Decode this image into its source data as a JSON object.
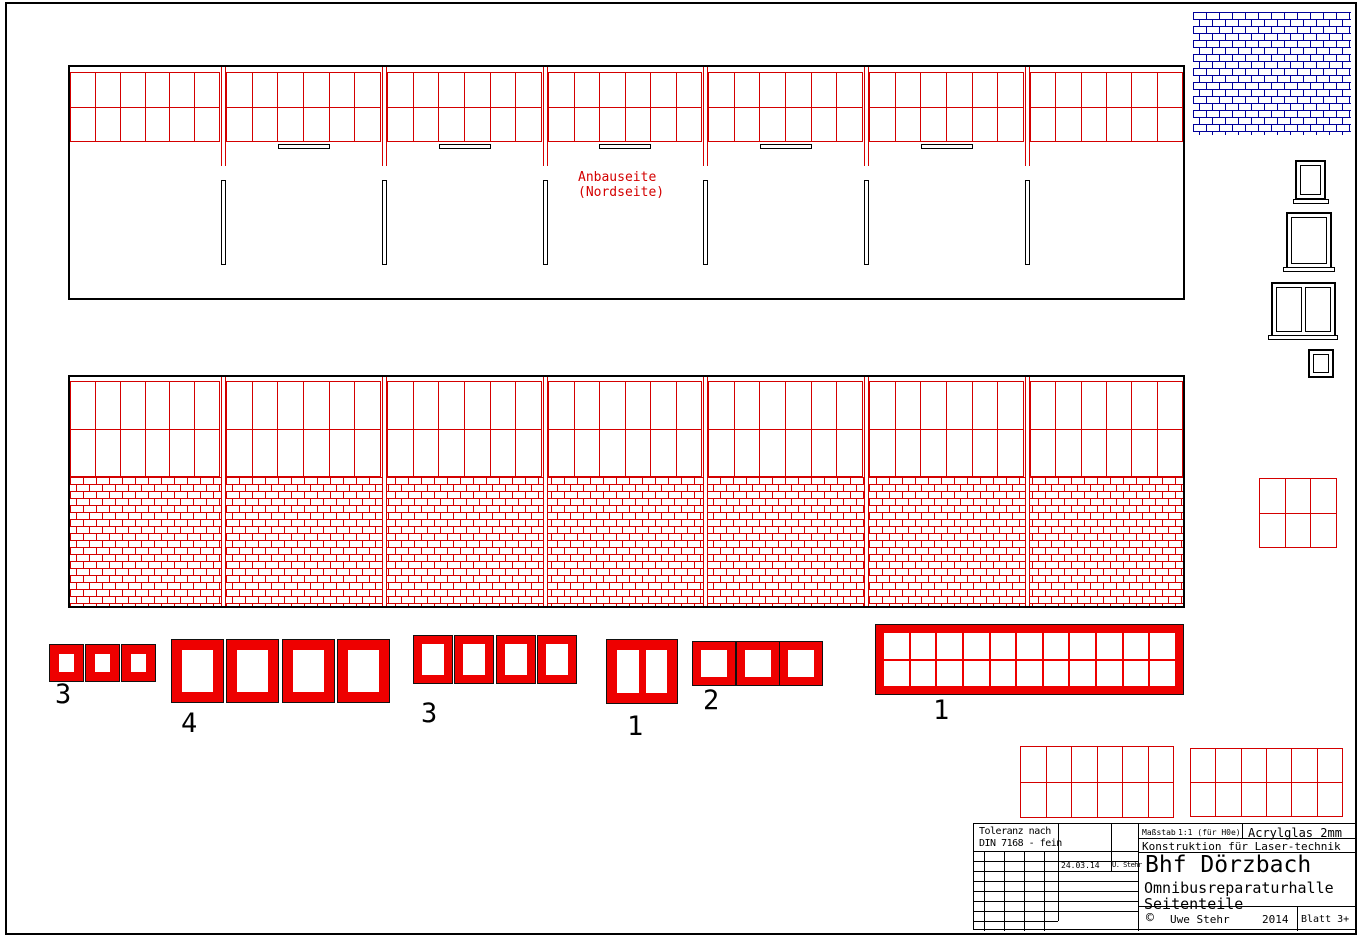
{
  "colors": {
    "red_line": "#d40000",
    "red_fill": "#ee0000",
    "blue": "#000099",
    "black": "#000000"
  },
  "annotations": {
    "north_label_line1": "Anbauseite",
    "north_label_line2": "(Nordseite)"
  },
  "structure": {
    "north_elevation": {
      "panels": 7,
      "window_cols": 6,
      "window_rows": 2,
      "dividers": 6,
      "pillars": 6,
      "sills": 5
    },
    "south_elevation": {
      "panels": 7,
      "window_cols": 6,
      "window_rows": 2,
      "brick_base": true,
      "dividers": 6
    },
    "blue_brick_panel": {
      "present": true
    },
    "right_window_grid": {
      "cells": "3x2"
    },
    "bottom_grid_1": {
      "cells": "6x2"
    },
    "bottom_grid_2": {
      "cells": "6x2"
    }
  },
  "parts": [
    {
      "id": "part3a",
      "label": "3",
      "count": 3
    },
    {
      "id": "part4",
      "label": "4",
      "count": 4
    },
    {
      "id": "part3b",
      "label": "3",
      "count": 4
    },
    {
      "id": "part1a",
      "label": "1",
      "count": 1,
      "panes": 2
    },
    {
      "id": "part2",
      "label": "2",
      "count": 3
    },
    {
      "id": "part1b",
      "label": "1",
      "count": 1,
      "grid": "11x2"
    }
  ],
  "title_block": {
    "tolerance_line1": "Toleranz nach",
    "tolerance_line2": "DIN 7168 - fein",
    "date": "24.03.14",
    "drafter": "U. Stehr",
    "scale_label": "Maßstab",
    "scale_value": "1:1 (für H0e)",
    "material": "Acrylglas 2mm",
    "construction": "Konstruktion für Laser-technik",
    "title": "Bhf Dörzbach",
    "subtitle1": "Omnibusreparaturhalle",
    "subtitle2": "Seitenteile",
    "copyright_symbol": "©",
    "author": "Uwe Stehr",
    "year": "2014",
    "sheet": "Blatt 3+"
  }
}
